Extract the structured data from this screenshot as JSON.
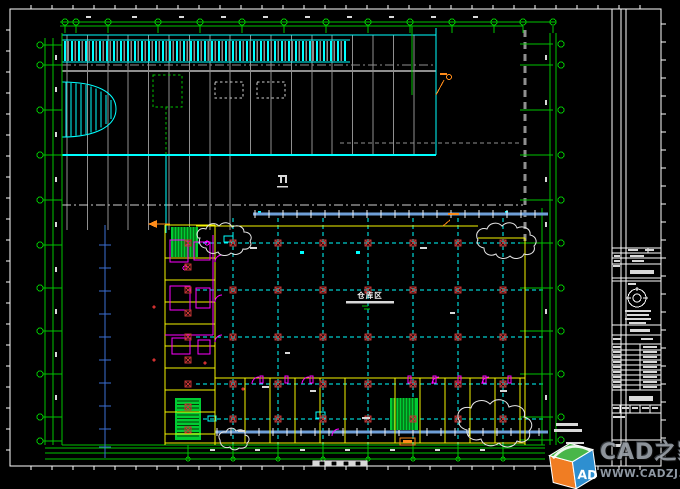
{
  "drawing": {
    "area_label": "仓库区",
    "colors": {
      "green": "#00c300",
      "cyan": "#00ffff",
      "gray": "#8f8f8f",
      "light": "#d9d9d9",
      "white": "#f0f0f0",
      "yellow": "#f5f500",
      "magenta": "#ff00ff",
      "red": "#c03434",
      "red_fill": "#d03030",
      "steel": "#6f9fd8",
      "blue": "#3b6fd4",
      "orange": "#ff8c1a",
      "stair": "#00cc33",
      "stair_dark": "#063c06",
      "cloud": "#e6e6e6",
      "dash_white": "#cfcfcf",
      "border": "#ffffff"
    }
  },
  "watermark": {
    "brand": "CAD之家",
    "url": "WWW.CADZJ.COM",
    "cube_letters": "AD",
    "colors": {
      "cube_top": "#49b649",
      "cube_left": "#f07d23",
      "cube_front": "#2e8fd0"
    }
  }
}
